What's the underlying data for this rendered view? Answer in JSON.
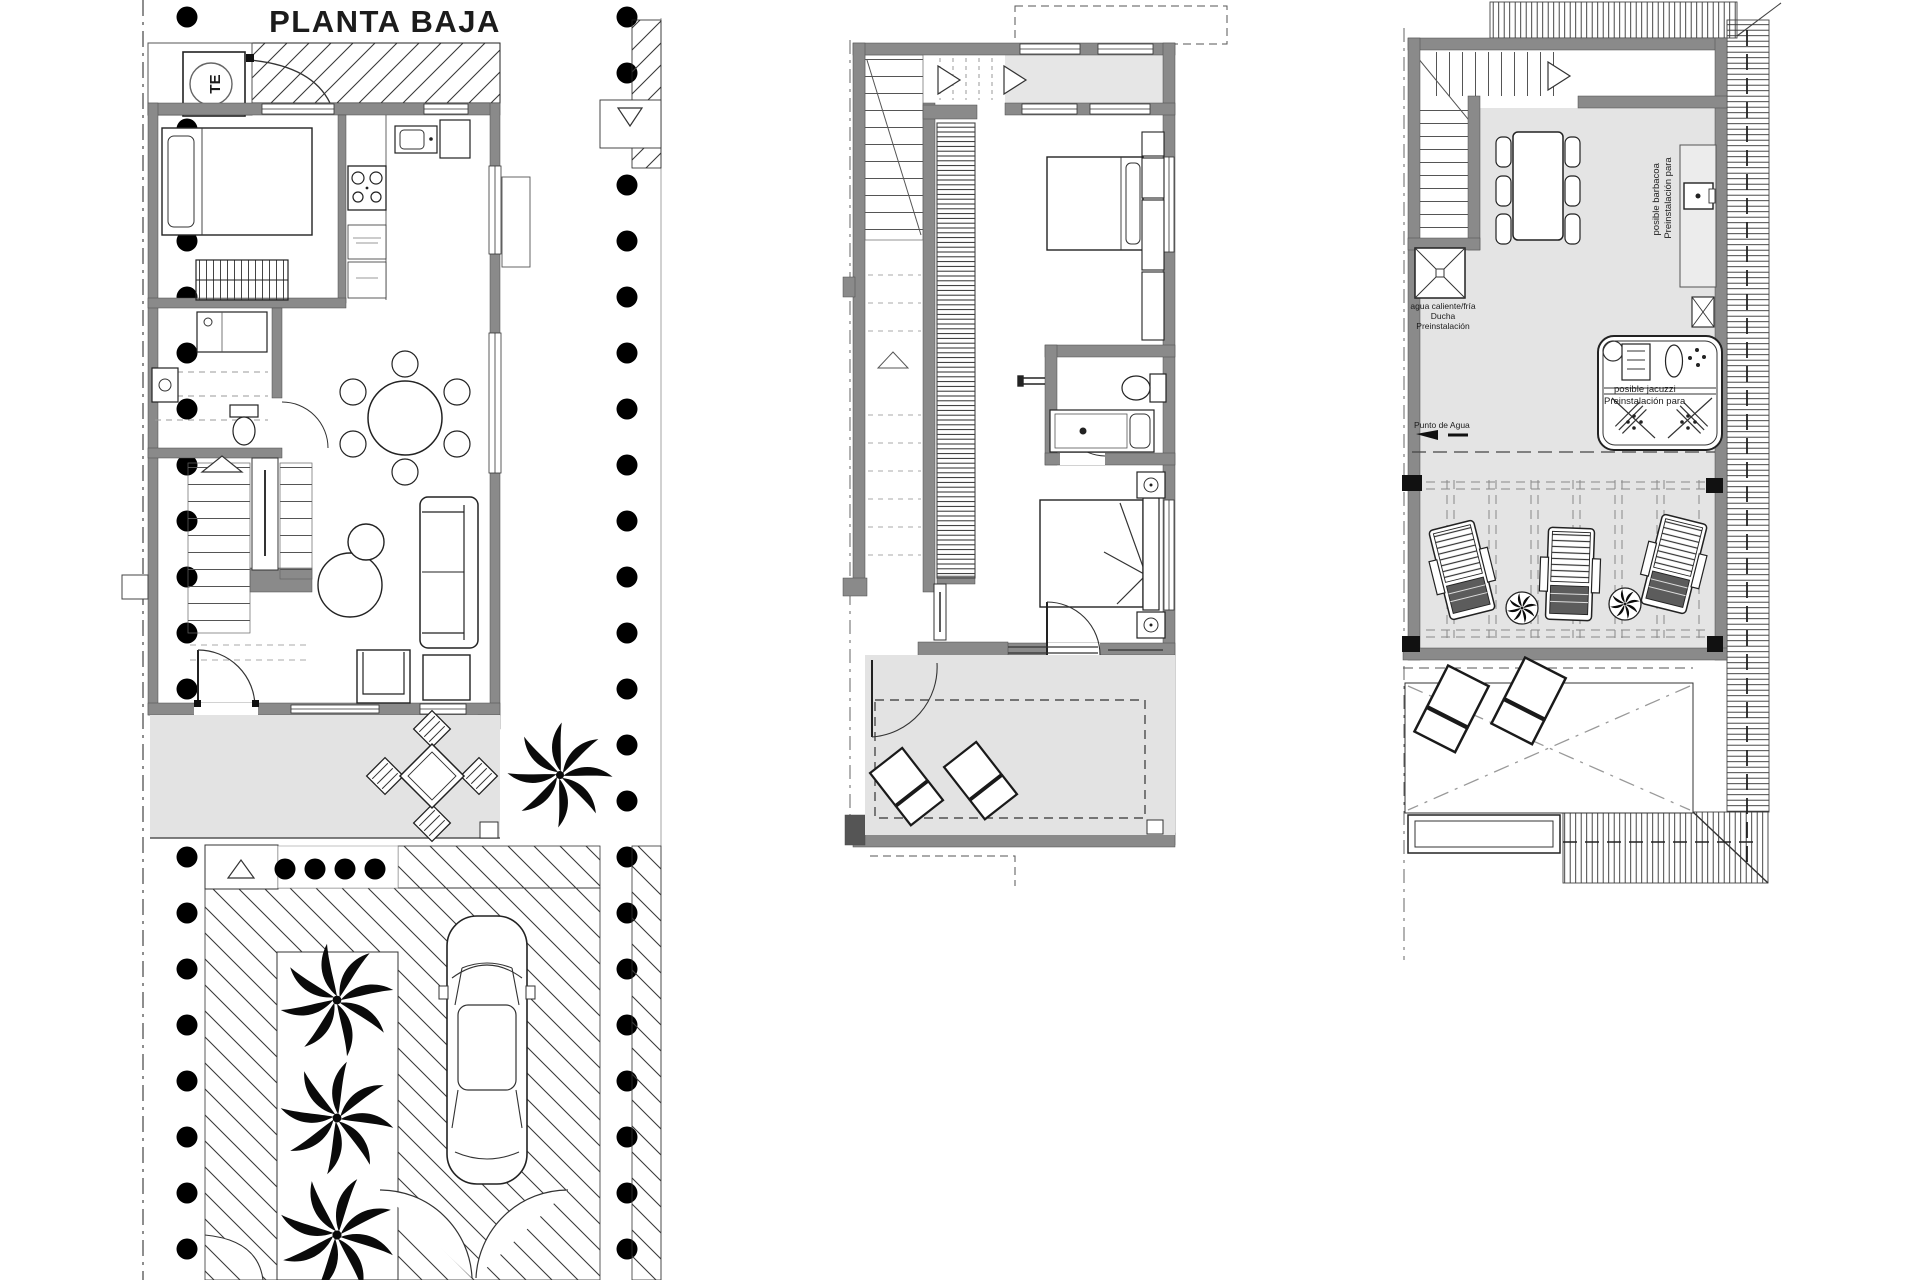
{
  "document": {
    "type": "architectural-floor-plans",
    "background": "#ffffff"
  },
  "colors": {
    "wall": "#8a8a8a",
    "wall_dark": "#555555",
    "floor_light": "#e6e6e6",
    "terrace": "#e3e3e3",
    "line": "#1f1f1f",
    "dot": "#000000"
  },
  "plans": {
    "ground_floor": {
      "name": "ground-floor-plan",
      "title": "PLANTA BAJA",
      "electrical_panel_label": "TE"
    },
    "first_floor": {
      "name": "first-floor-plan"
    },
    "roof_terrace": {
      "name": "roof-terrace-plan",
      "shower_note": [
        "agua caliente/fría",
        "Ducha",
        "Preinstalación"
      ],
      "barbecue_note": [
        "posible barbacoa",
        "Preinstalación para"
      ],
      "jacuzzi_note": [
        "posible jacuzzi",
        "Preinstalación para"
      ],
      "water_point_label": "Punto de Agua"
    }
  }
}
